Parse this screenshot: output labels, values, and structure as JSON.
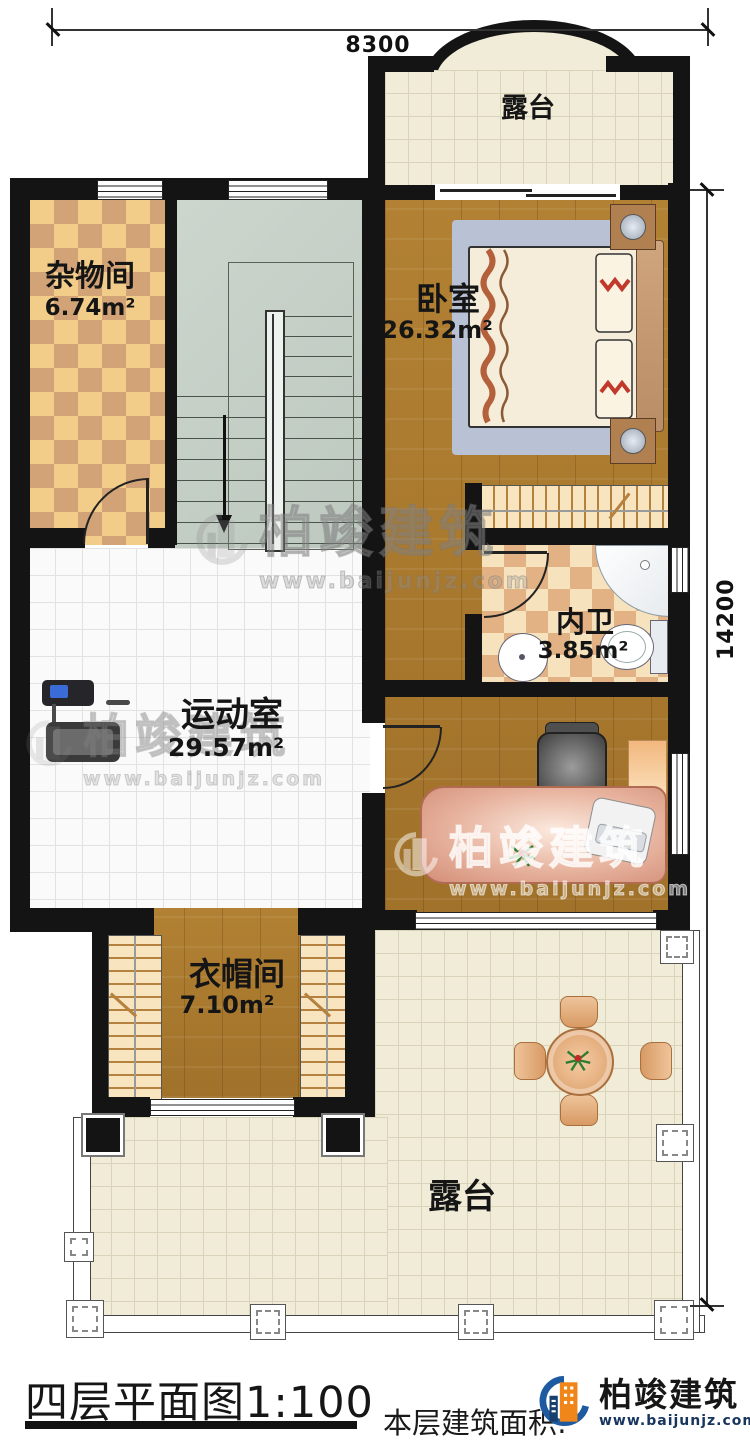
{
  "dimensions": {
    "top": "8300",
    "right": "14200"
  },
  "rooms": {
    "terrace_top": {
      "label": "露台"
    },
    "storage": {
      "label": "杂物间",
      "area": "6.74m²"
    },
    "bedroom": {
      "label": "卧室",
      "area": "26.32m²"
    },
    "bathroom": {
      "label": "内卫",
      "area": "3.85m²"
    },
    "gym": {
      "label": "运动室",
      "area": "29.57m²"
    },
    "cloakroom": {
      "label": "衣帽间",
      "area": "7.10m²"
    },
    "terrace_bottom": {
      "label": "露台"
    }
  },
  "footer": {
    "title": "四层平面图1:100",
    "area_note": "本层建筑面积:"
  },
  "brand": {
    "name": "柏竣建筑",
    "url": "www.baijunjz.com"
  },
  "colors": {
    "wall": "#141414",
    "wood": "#a9772e",
    "checker_light": "#f2cc89",
    "checker_dark": "#d2a377",
    "tile_beige": "#f1ecd8",
    "tile_white": "#fafafa",
    "stair": "#c6d0c7",
    "brand_blue": "#1e5aa0",
    "brand_orange": "#f08519",
    "desk": "#e0a58c",
    "bed_mat": "#b9c1d4"
  },
  "icons": [
    "down-arrow-icon",
    "building-logo-icon",
    "plant-icon"
  ]
}
